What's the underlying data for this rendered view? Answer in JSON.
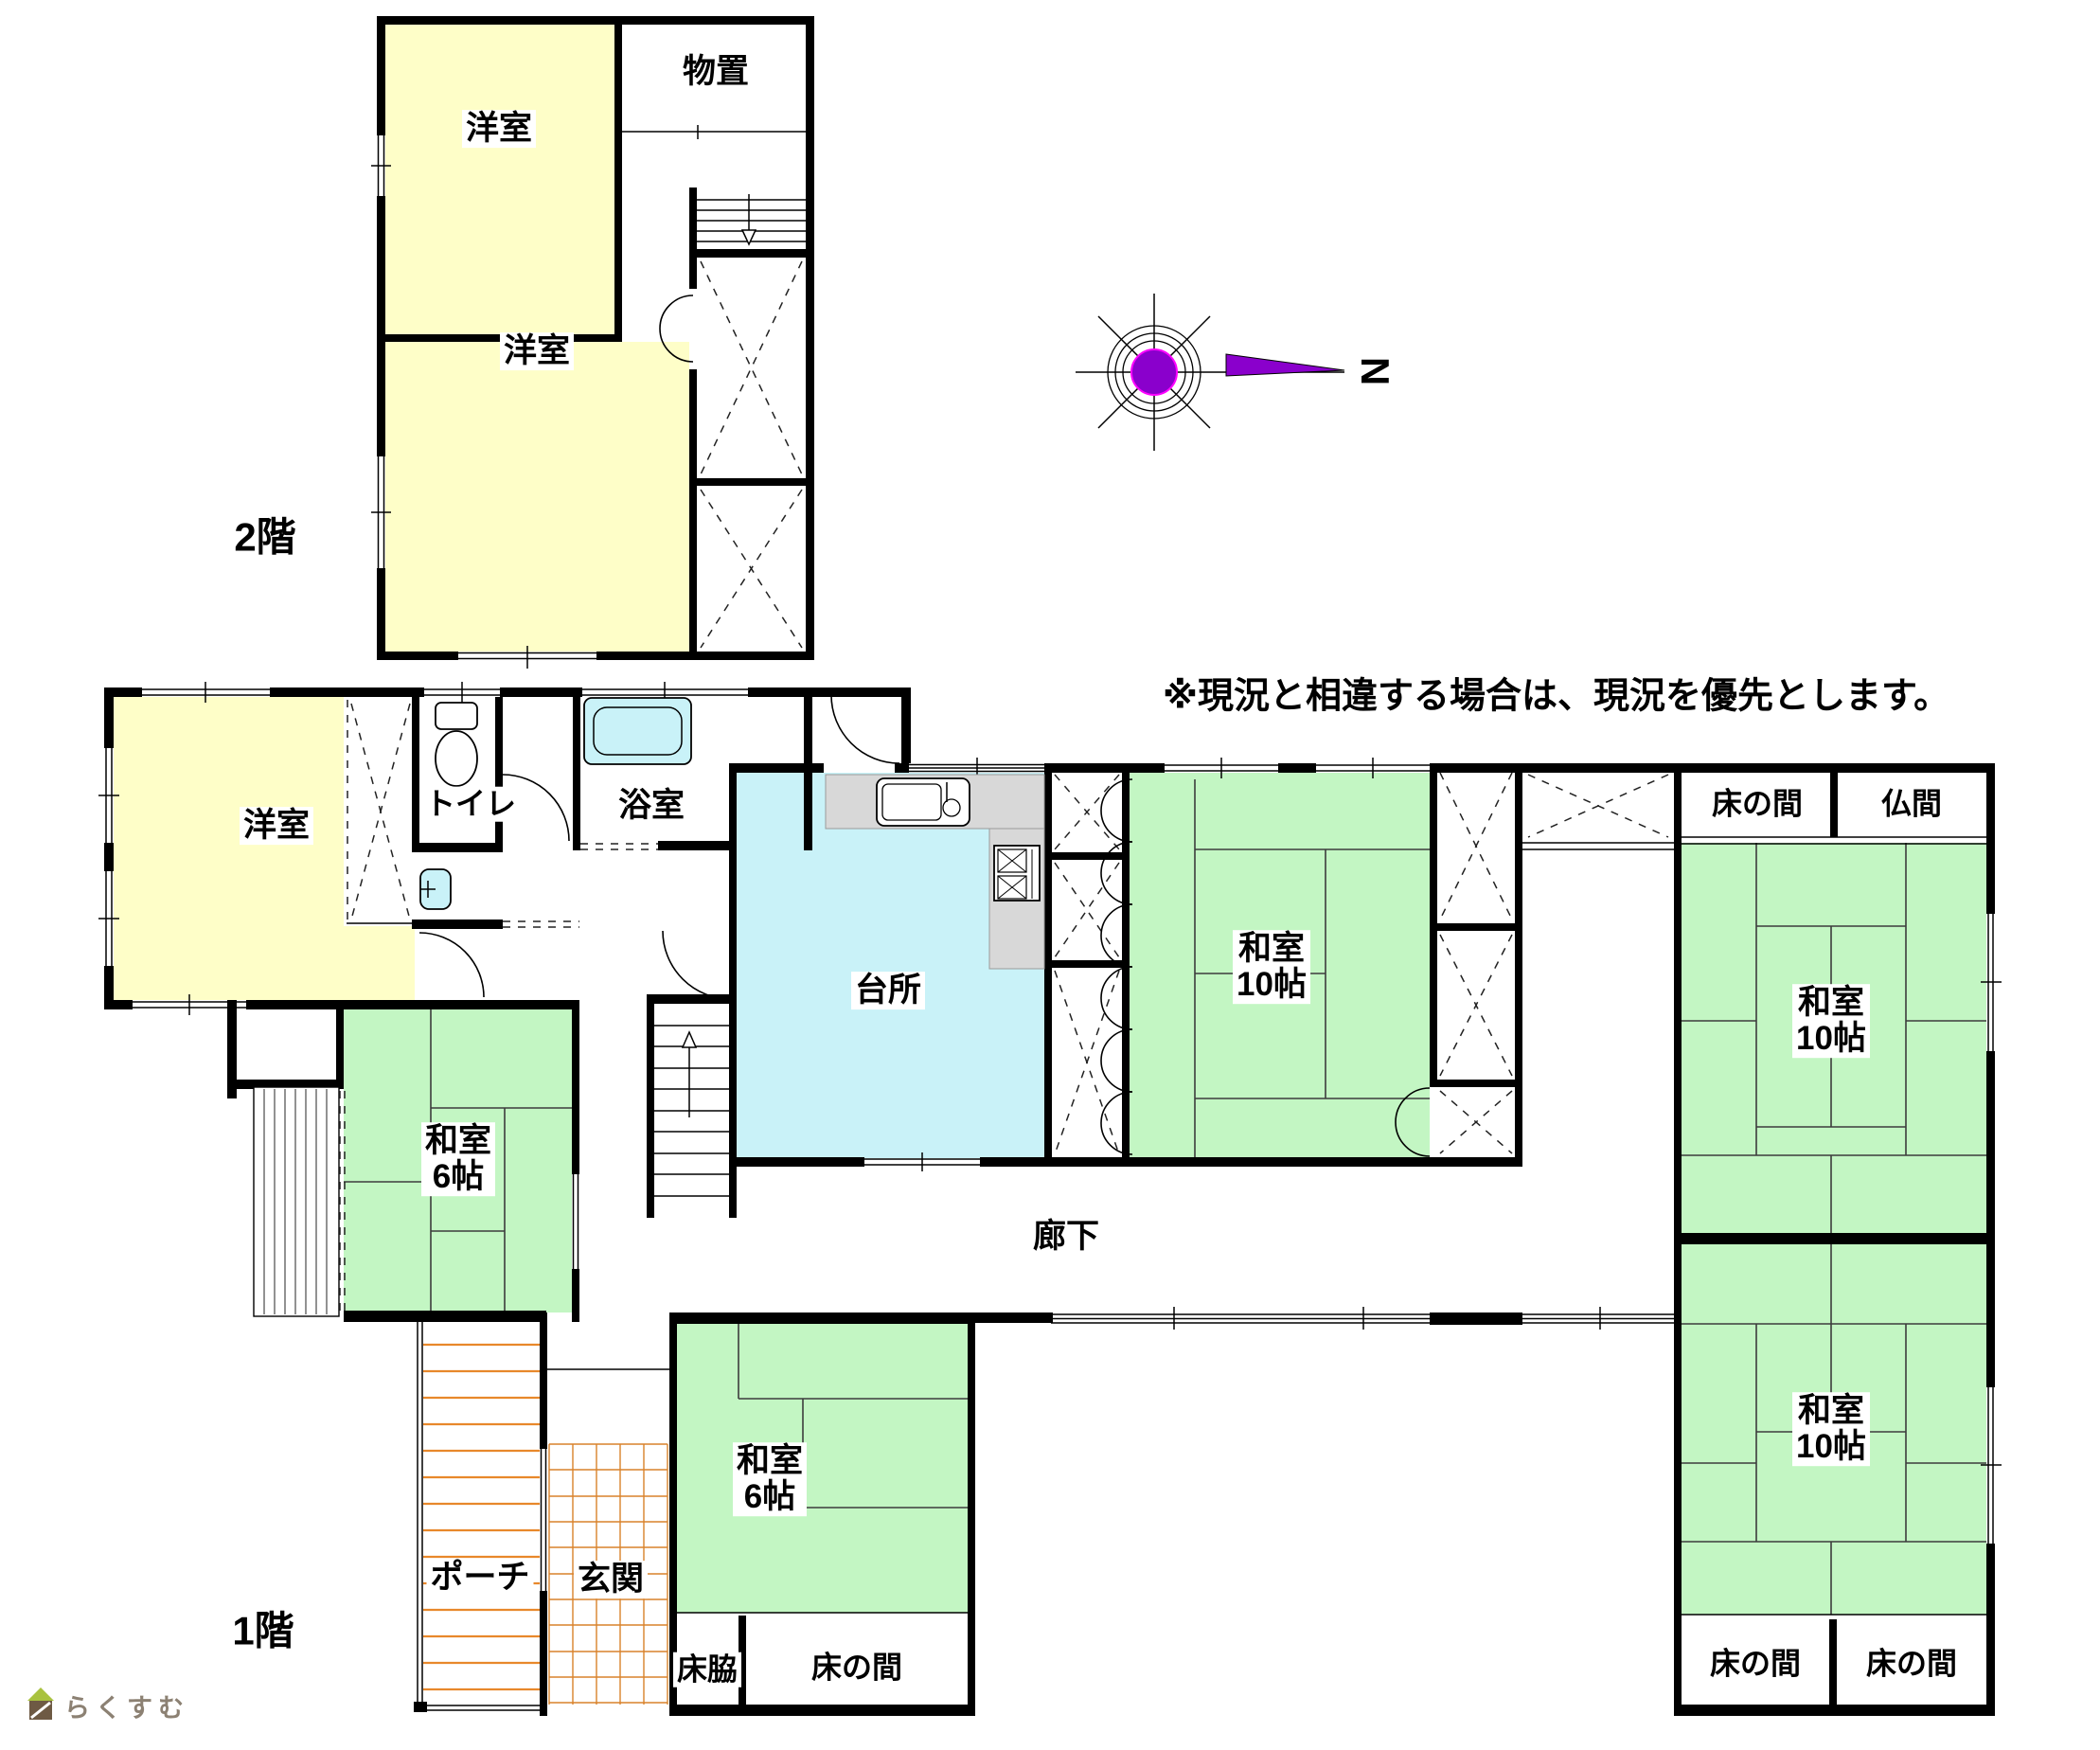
{
  "floors": {
    "f2": {
      "floor_label": "2階",
      "rooms": {
        "yoshitsu1": "洋室",
        "monooki": "物置",
        "yoshitsu2": "洋室"
      }
    },
    "f1": {
      "floor_label": "1階",
      "rooms": {
        "yoshitsu": "洋室",
        "toilet": "トイレ",
        "bath": "浴室",
        "kitchen": "台所",
        "washitsu10c_1": "和室",
        "washitsu10c_2": "10帖",
        "tokonoma_ne": "床の間",
        "butsuma": "仏間",
        "washitsu10e1_1": "和室",
        "washitsu10e1_2": "10帖",
        "washitsu10e2_1": "和室",
        "washitsu10e2_2": "10帖",
        "tokonoma_se_left": "床の間",
        "tokonoma_se_right": "床の間",
        "washitsu6w_1": "和室",
        "washitsu6w_2": "6帖",
        "washitsu6s_1": "和室",
        "washitsu6s_2": "6帖",
        "tokowaki": "床脇",
        "tokonoma_s": "床の間",
        "rouka": "廊下",
        "porch": "ポーチ",
        "genkan": "玄関"
      }
    }
  },
  "note": "※現況と相違する場合は、現況を優先とします。",
  "compass": {
    "north": "N"
  },
  "watermark": {
    "text": "らくすむ"
  },
  "colors": {
    "wall": "#000000",
    "tatami_green": "#C3F6C3",
    "western_yellow": "#FEFEC8",
    "water_cyan": "#C9F2F8",
    "counter_gray": "#D8D8D8",
    "porch_orange": "#E8882B",
    "compass_purple": "#8A00CC"
  }
}
